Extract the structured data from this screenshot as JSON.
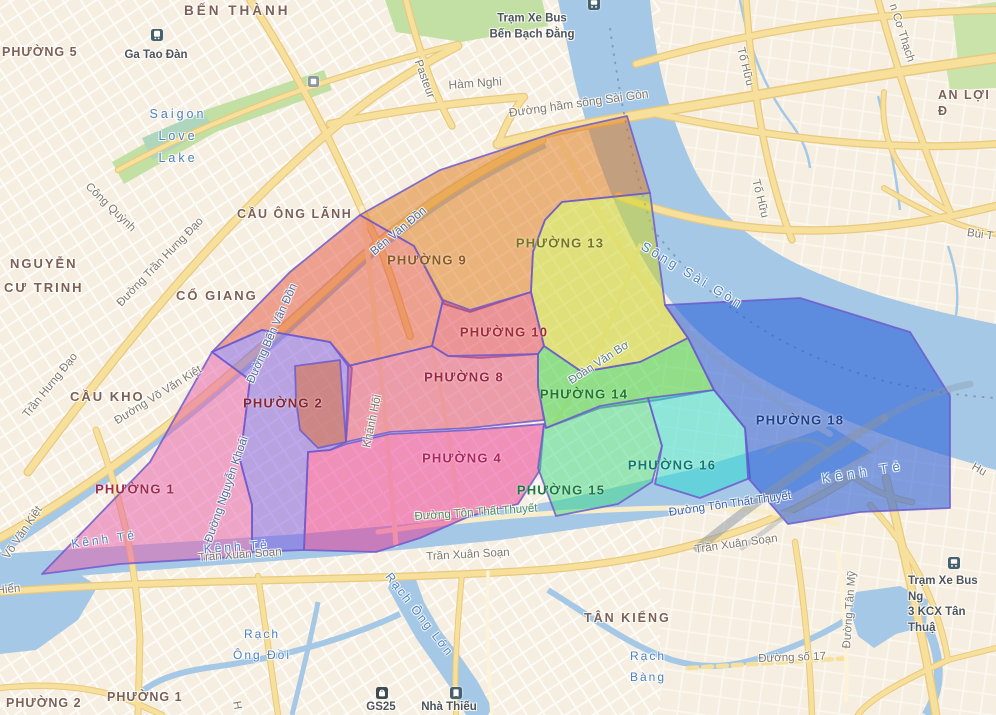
{
  "canvas": {
    "width": 996,
    "height": 715
  },
  "colors": {
    "land": "#f6efe1",
    "water": "#a5c8e6",
    "park": "#c2e0a4",
    "road_fill": "#f7e09c",
    "road_casing": "#e9c97e",
    "road_cream": "#f9edc9",
    "ward_border": "#6f5acd",
    "water_label": "#4d80c0",
    "street_label": "#7e776c",
    "area_label": "#7c5f55",
    "poi_label": "#4e5358",
    "bridge_gray": "#8a94a2"
  },
  "wards": [
    {
      "name": "",
      "fill": "#e04028",
      "opacity": 0.45,
      "label_color": "",
      "label_x": 0,
      "label_y": 0,
      "points": "212,352 290,272 360,215 414,246 443,300 432,346 348,366 330,342 262,330"
    },
    {
      "name": "PHƯỜNG 2",
      "fill": "#7b55e0",
      "opacity": 0.5,
      "label_color": "#8a2430",
      "label_x": 283,
      "label_y": 404,
      "points": "212,352 262,330 330,342 352,368 346,442 330,450 308,452 304,550 252,552 252,505 240,460 250,380"
    },
    {
      "name": "",
      "fill": "#e06a28",
      "opacity": 0.5,
      "label_color": "",
      "label_x": 0,
      "label_y": 0,
      "points": "295,366 340,360 346,442 318,448 300,430 296,400"
    },
    {
      "name": "PHƯỜNG 1",
      "fill": "#e55aa8",
      "opacity": 0.5,
      "label_color": "#9e2b50",
      "label_x": 135,
      "label_y": 490,
      "points": "42,574 150,462 212,352 250,380 240,460 252,505 252,552 250,556 120,564"
    },
    {
      "name": "PHƯỜNG 9",
      "fill": "#e07818",
      "opacity": 0.5,
      "label_color": "#8a5a20",
      "label_x": 427,
      "label_y": 261,
      "points": "360,215 440,170 560,131 627,116 650,193 562,202 545,220 533,252 531,292 470,312 444,304 414,246"
    },
    {
      "name": "PHƯỜNG 13",
      "fill": "#cdd428",
      "opacity": 0.55,
      "label_color": "#77761c",
      "label_x": 560,
      "label_y": 244,
      "points": "650,193 665,305 688,338 640,362 582,372 544,346 531,292 533,252 545,220 562,202"
    },
    {
      "name": "PHƯỜNG 10",
      "fill": "#df3a4a",
      "opacity": 0.5,
      "label_color": "#a32a35",
      "label_x": 504,
      "label_y": 333,
      "points": "432,346 443,300 470,310 531,292 544,346 538,354 480,358 448,356"
    },
    {
      "name": "PHƯỜNG 8",
      "fill": "#e04a70",
      "opacity": 0.5,
      "label_color": "#9c2744",
      "label_x": 464,
      "label_y": 378,
      "points": "348,366 432,346 448,356 538,354 538,386 544,420 470,428 390,432 346,442"
    },
    {
      "name": "PHƯỜNG 4",
      "fill": "#ea2f90",
      "opacity": 0.5,
      "label_color": "#b02560",
      "label_x": 462,
      "label_y": 459,
      "points": "346,444 390,434 470,430 544,424 540,470 518,504 470,516 420,538 376,552 304,550 308,452 330,450"
    },
    {
      "name": "PHƯỜNG 14",
      "fill": "#2ecc30",
      "opacity": 0.5,
      "label_color": "#1d7a2e",
      "label_x": 584,
      "label_y": 395,
      "points": "544,346 582,372 640,362 688,338 714,390 658,400 600,408 546,428 538,386 538,354"
    },
    {
      "name": "PHƯỜNG 15",
      "fill": "#3cd986",
      "opacity": 0.5,
      "label_color": "#1b7a44",
      "label_x": 561,
      "label_y": 491,
      "points": "546,428 600,406 648,398 662,446 652,482 618,504 556,516 538,468 544,424"
    },
    {
      "name": "PHƯỜNG 16",
      "fill": "#26dcd0",
      "opacity": 0.5,
      "label_color": "#0f7a70",
      "label_x": 672,
      "label_y": 466,
      "points": "648,398 714,390 745,428 750,478 700,498 655,484 662,446"
    },
    {
      "name": "PHƯỜNG 18",
      "fill": "#2a5fd8",
      "opacity": 0.58,
      "label_color": "#1c3f8f",
      "label_x": 800,
      "label_y": 421,
      "points": "665,305 800,298 910,332 950,396 950,508 860,512 788,524 748,478 745,428 714,390 688,338"
    }
  ],
  "area_labels": [
    {
      "text": "BẾN THÀNH",
      "x": 184,
      "y": 2,
      "size": 13.5,
      "ls": 3,
      "rot": 0
    },
    {
      "text": "PHƯỜNG 5",
      "x": 2,
      "y": 44,
      "size": 12.5,
      "ls": 1,
      "rot": 0
    },
    {
      "text": "CẦU ÔNG LÃNH",
      "x": 237,
      "y": 206,
      "size": 12.5,
      "ls": 1.5,
      "rot": 0
    },
    {
      "text": "NGUYỄN\nCƯ TRINH",
      "x": 4,
      "y": 252,
      "size": 13,
      "ls": 2,
      "rot": 0
    },
    {
      "text": "CỔ GIANG",
      "x": 176,
      "y": 288,
      "size": 13,
      "ls": 2,
      "rot": 0
    },
    {
      "text": "CẦU KHO",
      "x": 70,
      "y": 389,
      "size": 13,
      "ls": 2,
      "rot": 0
    },
    {
      "text": "TÂN KIỂNG",
      "x": 584,
      "y": 610,
      "size": 12.5,
      "ls": 2,
      "rot": 0
    },
    {
      "text": "AN LỢI Đ",
      "x": 938,
      "y": 87,
      "size": 12.5,
      "ls": 1.5,
      "rot": 0
    },
    {
      "text": "PHƯỜNG 2",
      "x": 6,
      "y": 695,
      "size": 12.5,
      "ls": 1,
      "rot": 0
    },
    {
      "text": "PHƯỜNG 1",
      "x": 107,
      "y": 689,
      "size": 12.5,
      "ls": 1,
      "rot": 0
    }
  ],
  "street_labels": [
    {
      "text": "Hàm Nghi",
      "x": 448,
      "y": 78,
      "rot": -4,
      "size": 12
    },
    {
      "text": "Pasteur",
      "x": 424,
      "y": 58,
      "rot": 70
    },
    {
      "text": "Công Quỳnh",
      "x": 92,
      "y": 180,
      "rot": 44
    },
    {
      "text": "Đường Trần Hưng Đạo",
      "x": 114,
      "y": 300,
      "rot": -46
    },
    {
      "text": "Trần Hưng Đạo",
      "x": 20,
      "y": 412,
      "rot": -51
    },
    {
      "text": "Đường hầm sông Sài Gòn",
      "x": 508,
      "y": 106,
      "rot": -8,
      "size": 12
    },
    {
      "text": "Tố Hữu",
      "x": 747,
      "y": 46,
      "rot": 76
    },
    {
      "text": "Tố Hữu",
      "x": 762,
      "y": 178,
      "rot": 76
    },
    {
      "text": "n Cơ Thạch",
      "x": 899,
      "y": 2,
      "rot": 72
    },
    {
      "text": "Bùi T",
      "x": 968,
      "y": 226,
      "rot": 8
    },
    {
      "text": "Đường Võ Văn Kiệt",
      "x": 112,
      "y": 416,
      "rot": -32
    },
    {
      "text": "Võ Văn Kiệt",
      "x": 0,
      "y": 554,
      "rot": -56
    },
    {
      "text": "Đường Bến Vân Đồn",
      "x": 244,
      "y": 380,
      "rot": -66,
      "color": "#4f6d9e"
    },
    {
      "text": "Bến Vân Đồn",
      "x": 368,
      "y": 248,
      "rot": -40,
      "color": "#4f6d9e"
    },
    {
      "text": "Đường Nguyễn Khoái",
      "x": 202,
      "y": 540,
      "rot": -71,
      "color": "#4f6d9e"
    },
    {
      "text": "Khánh Hội",
      "x": 360,
      "y": 446,
      "rot": -78
    },
    {
      "text": "Đoàn Văn Bơ",
      "x": 566,
      "y": 376,
      "rot": -33,
      "color": "#5e7d8c"
    },
    {
      "text": "Đường Tôn Thất Thuyết",
      "x": 414,
      "y": 510,
      "rot": -4,
      "color": "#4e8a58"
    },
    {
      "text": "Đường Tôn Thất Thuyết",
      "x": 668,
      "y": 506,
      "rot": -8,
      "color": "#3d5fa8"
    },
    {
      "text": "Trần Xuân Soạn",
      "x": 198,
      "y": 551,
      "rot": -4
    },
    {
      "text": "Trần Xuân Soạn",
      "x": 426,
      "y": 550,
      "rot": -3
    },
    {
      "text": "Trần Xuân Soạn",
      "x": 694,
      "y": 543,
      "rot": -8
    },
    {
      "text": "Đường Tân Mỹ",
      "x": 840,
      "y": 648,
      "rot": -86
    },
    {
      "text": "Đường số 17",
      "x": 758,
      "y": 652,
      "rot": -2
    },
    {
      "text": "Hu",
      "x": 976,
      "y": 460,
      "rot": 30
    },
    {
      "text": "Hiển",
      "x": -4,
      "y": 584,
      "rot": -6
    },
    {
      "text": "H",
      "x": 243,
      "y": 700,
      "rot": 80
    }
  ],
  "water_labels": [
    {
      "text": "Saigon\nLove\nLake",
      "x": 178,
      "y": 137,
      "rot": 0,
      "size": 12.5,
      "ls": 3,
      "center": true
    },
    {
      "text": "Sông Sài Gòn",
      "x": 648,
      "y": 236,
      "rot": 31,
      "size": 13,
      "ls": 3
    },
    {
      "text": "Kênh Tẻ",
      "x": 70,
      "y": 534,
      "rot": -8,
      "ls": 3
    },
    {
      "text": "Kênh Tẻ",
      "x": 203,
      "y": 539,
      "rot": -4,
      "ls": 3
    },
    {
      "text": "Kênh Tẻ",
      "x": 820,
      "y": 468,
      "rot": -9,
      "size": 13,
      "ls": 5
    },
    {
      "text": "Rạch Ông Lớn",
      "x": 396,
      "y": 568,
      "rot": 52,
      "ls": 2
    },
    {
      "text": "Rạch\nÔng Đồi",
      "x": 262,
      "y": 645,
      "rot": 0,
      "ls": 2,
      "center": true
    },
    {
      "text": "Rạch\nBàng",
      "x": 648,
      "y": 667,
      "rot": 0,
      "ls": 2,
      "center": true
    }
  ],
  "poi": [
    {
      "icon": "bus-icon",
      "icon_x": 588,
      "icon_y": -3,
      "text": "Trạm Xe Bus\nBến Bạch Đằng",
      "text_x": 532,
      "text_y": 27,
      "align": "center"
    },
    {
      "icon": "train-icon",
      "icon_x": 151,
      "icon_y": 28,
      "text": "Ga Tao Đàn",
      "text_x": 156,
      "text_y": 56,
      "align": "center"
    },
    {
      "icon": "transit-icon",
      "icon_x": 308,
      "icon_y": 74,
      "text": "",
      "text_x": 0,
      "text_y": 0,
      "align": "center"
    },
    {
      "icon": "shop-icon",
      "icon_x": 376,
      "icon_y": 686,
      "text": "GS25",
      "text_x": 381,
      "text_y": 708,
      "align": "center"
    },
    {
      "icon": "building-icon",
      "icon_x": 450,
      "icon_y": 686,
      "text": "Nhà Thiếu",
      "text_x": 449,
      "text_y": 708,
      "align": "center"
    },
    {
      "icon": "bus-icon",
      "icon_x": 948,
      "icon_y": 556,
      "text": "Trạm Xe Bus Ng\n3 KCX Tân Thuậ",
      "text_x": 908,
      "text_y": 574,
      "align": "left"
    }
  ]
}
